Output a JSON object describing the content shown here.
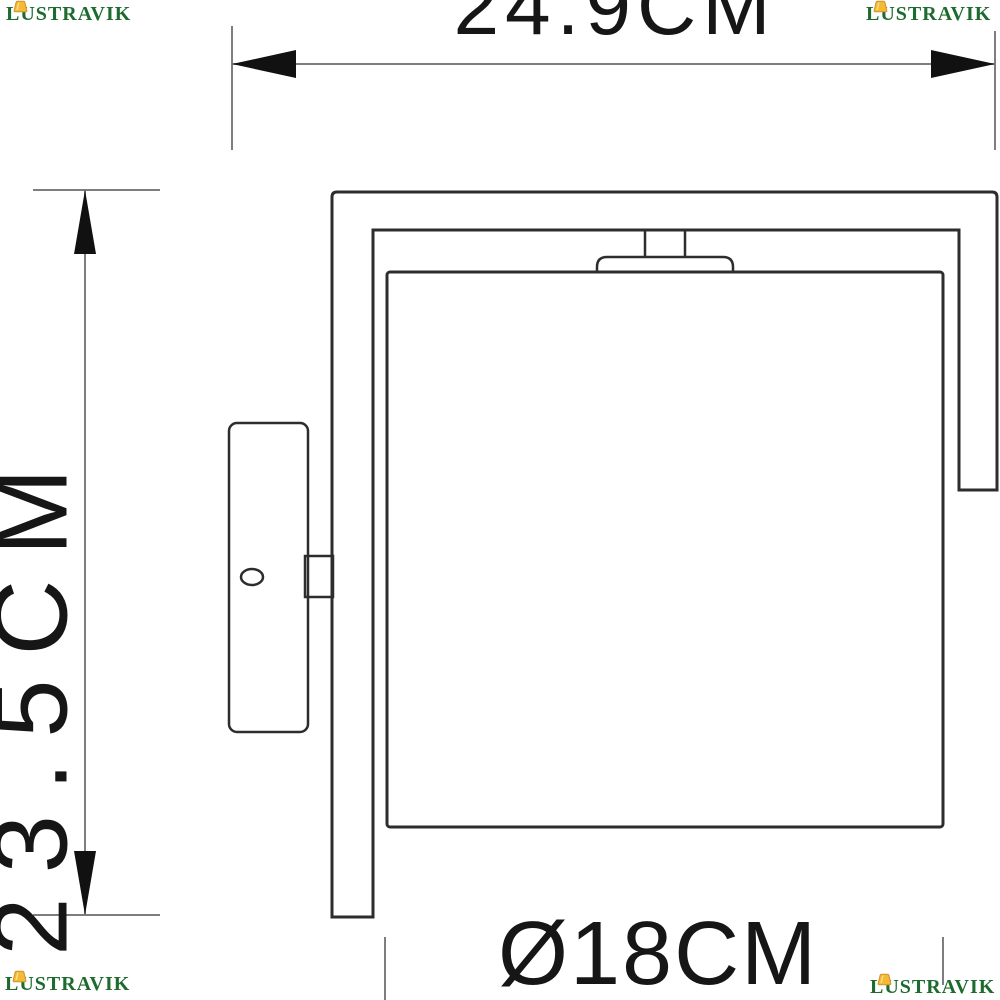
{
  "brand": {
    "name": "LUSTRAVIK",
    "icon": "lampshade-icon",
    "color": "#1e6b2f",
    "icon_color": "#f3ba38",
    "icon_stroke": "#cf9327"
  },
  "dimensions": {
    "width": {
      "label": "24.9CM",
      "value_cm": 24.9,
      "orientation": "horizontal"
    },
    "height": {
      "label": "23.5CM",
      "value_cm": 23.5,
      "orientation": "vertical"
    },
    "diameter": {
      "label": "Ø18CM",
      "value_cm": 18,
      "orientation": "horizontal"
    }
  },
  "drawing": {
    "subject": "wall-sconce-technical-drawing",
    "parts": [
      "frame-arm",
      "square-shade",
      "socket-cap",
      "stem",
      "wall-plate",
      "mount-arm",
      "screw-hole"
    ]
  },
  "colors": {
    "ink": "#111111",
    "draw": "#2d2d2d",
    "line-gray": "#7e7e7e",
    "brand-green": "#1e6b2f",
    "brand-yellow": "#f3ba38"
  }
}
